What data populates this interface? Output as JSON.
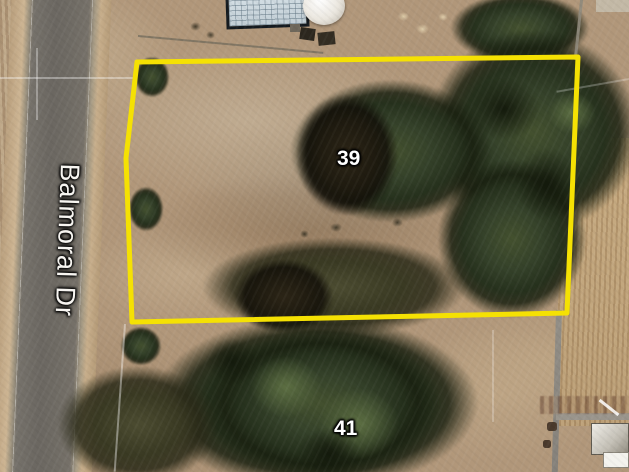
{
  "map": {
    "type": "satellite",
    "road_label": "Balmoral Dr",
    "parcels": [
      {
        "number": "39",
        "outlined": true
      },
      {
        "number": "41",
        "outlined": false
      }
    ],
    "boundary_color": "#f5e103"
  }
}
